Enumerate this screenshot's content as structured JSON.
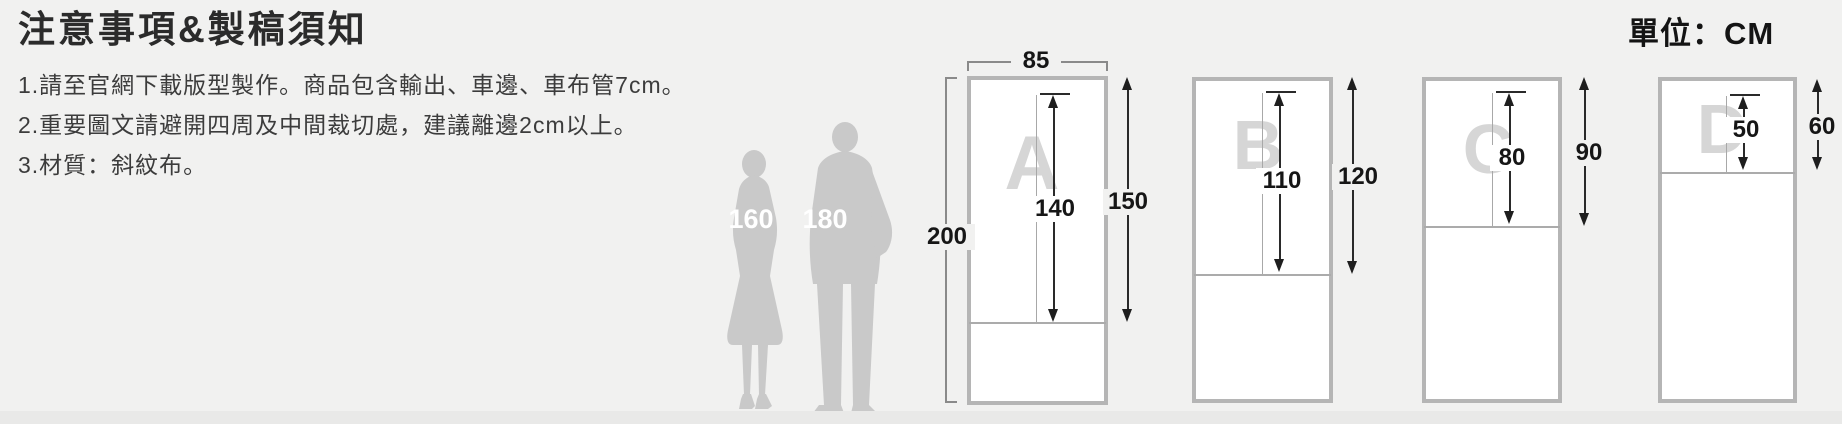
{
  "page": {
    "unit_label": "單位：CM",
    "colors": {
      "background": "#f1f1f0",
      "frame_border": "#b5b5b5",
      "watermark_letter": "#d6d6d6",
      "silhouette": "#c9c9c9",
      "dimension_text": "#161616"
    }
  },
  "notes": {
    "title": "注意事項&製稿須知",
    "items": [
      "1.請至官網下載版型製作。商品包含輸出、車邊、車布管7cm。",
      "2.重要圖文請避開四周及中間裁切處，建議離邊2cm以上。",
      "3.材質：斜紋布。"
    ]
  },
  "scale_figures": {
    "female_label": "160",
    "male_label": "180"
  },
  "diagrams": [
    {
      "letter": "A",
      "top_width": "85",
      "total_height": "200",
      "inner_height": "140",
      "outer_height": "150"
    },
    {
      "letter": "B",
      "inner_height": "110",
      "outer_height": "120"
    },
    {
      "letter": "C",
      "inner_height": "80",
      "outer_height": "90"
    },
    {
      "letter": "D",
      "inner_height": "50",
      "outer_height": "60"
    }
  ]
}
